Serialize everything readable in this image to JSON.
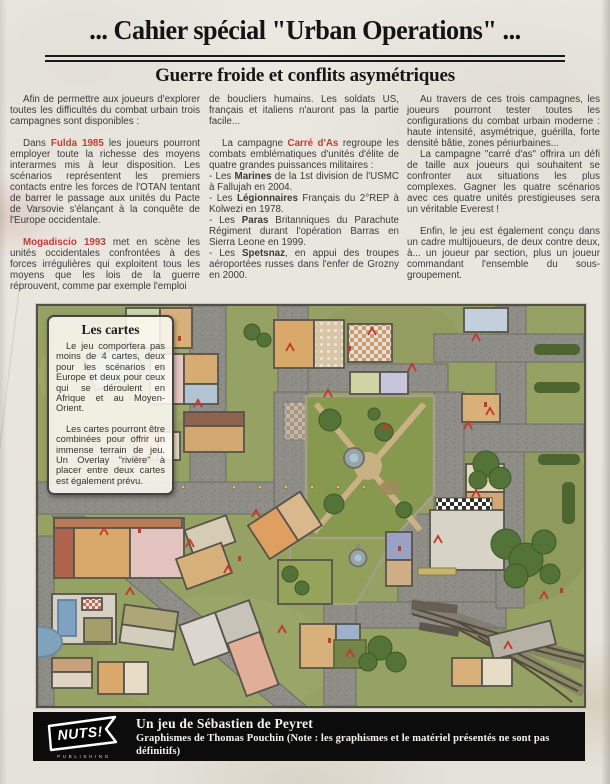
{
  "header": {
    "title": "... Cahier spécial \"Urban Operations\" ...",
    "subtitle": "Guerre froide et conflits asymétriques"
  },
  "columns": {
    "col1": {
      "p1": "Afin de permettre aux joueurs d'explorer toutes les difficultés du combat urbain trois campagnes sont disponibles :",
      "p2a": "Dans ",
      "p2b": "Fulda 1985",
      "p2c": " les joueurs pourront employer toute la richesse des moyens interarmes mis à leur disposition. Les scénarios représentent les premiers contacts entre les forces de l'OTAN tentant de barrer le passage aux unités du Pacte de Varsovie s'élançant à la conquête de l'Europe occidentale.",
      "p3a": "Mogadiscio 1993",
      "p3b": " met en scène les unités occidentales confrontées à des forces irrégulières qui exploitent tous les moyens que les lois de la guerre réprouvent, comme par exemple l'emploi"
    },
    "col2": {
      "p1": "de boucliers humains. Les soldats US, français et italiens n'auront pas la partie facile...",
      "p2a": "La campagne ",
      "p2b": "Carré d'As",
      "p2c": " regroupe les combats emblématiques d'unités d'élite de quatre grandes puissances militaires :",
      "li1a": "- Les ",
      "li1b": "Marines",
      "li1c": " de la 1st division de l'USMC à Fallujah en 2004.",
      "li2a": "- Les ",
      "li2b": "Légionnaires",
      "li2c": " Français du 2°REP à Kolwezi en 1978.",
      "li3a": "- Les ",
      "li3b": "Paras",
      "li3c": " Britanniques du Parachute Régiment durant l'opération Barras en Sierra Leone en 1999.",
      "li4a": "- Les ",
      "li4b": "Spetsnaz",
      "li4c": ", en appui des troupes aéroportées russes dans l'enfer de Grozny en 2000."
    },
    "col3": {
      "p1": "Au travers de ces trois campagnes, les joueurs pourront tester toutes les configurations du combat urbain moderne : haute intensité, asymétrique, guérilla, forte densité bâtie, zones périurbaines...",
      "p2": "La campagne \"carré d'as\" offrira un défi de taille aux joueurs qui souhaitent se confronter aux situations les plus complexes. Gagner les quatre scénarios avec ces quatre unités prestigieuses sera un véritable Everest !",
      "p3": "Enfin, le jeu est également conçu dans un cadre multijoueurs, de deux contre deux, à... un joueur par section, plus un joueur commandant l'ensemble du sous-groupement."
    }
  },
  "cartes_box": {
    "title": "Les cartes",
    "p1": "Le jeu comportera pas moins de 4 cartes, deux pour les scénarios en Europe et deux pour ceux qui se déroulent en Afrique et au Moyen-Orient.",
    "p2": "Les cartes pourront être combinées pour offrir un immense terrain de jeu. Un Overlay \"rivière\" à placer entre deux cartes est également prévu."
  },
  "map": {
    "name": "urban-aerial-game-map"
  },
  "footer": {
    "logo_text": "NUTS!",
    "logo_sub": "PUBLISHING",
    "line1": "Un jeu de Sébastien de Peyret",
    "line2": "Graphismes de Thomas Pouchin (Note : les graphismes et le matériel présentés ne sont pas définitifs)"
  },
  "colors": {
    "accent_red": "#c43b35",
    "footer_bg": "#0c0c0c",
    "paper": "#eae7e0"
  }
}
